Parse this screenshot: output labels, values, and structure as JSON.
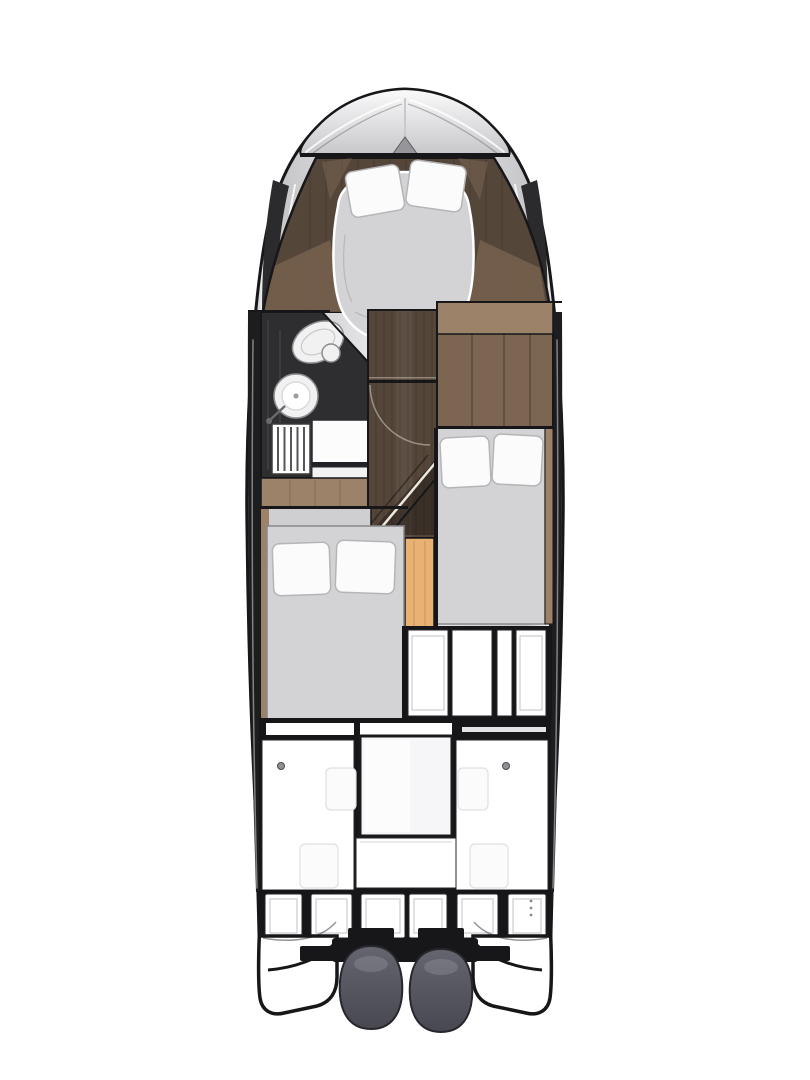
{
  "colors": {
    "background": "#ffffff",
    "outline": "#17171a",
    "hull_silver_light": "#f2f2f4",
    "hull_silver": "#c7c7ca",
    "hull_silver_dark": "#86868b",
    "hull_recess": "#2b2b2e",
    "side_band": "#1d1d20",
    "deck_top": "#fbfbfc",
    "wood_dark": "#55463a",
    "wood_medium": "#7c6652",
    "wood_light": "#9c8269",
    "floor_gray": "#cfcfd1",
    "bed_gray": "#d3d3d5",
    "bed_edge": "#a9a9ac",
    "pillow": "#fbfbfc",
    "pillow_edge": "#b5b5b8",
    "orange_panel": "#e9b273",
    "head_floor": "#2e2e31",
    "fixture_white": "#f1f1f2",
    "fixture_edge": "#8e8e92",
    "panel_white": "#ffffff",
    "panel_inner": "#cbcbce",
    "dark_fill": "#161618",
    "engine_top": "#656570",
    "engine_bottom": "#484851",
    "engine_edge": "#26262c",
    "chevron_gray": "#96969a"
  }
}
